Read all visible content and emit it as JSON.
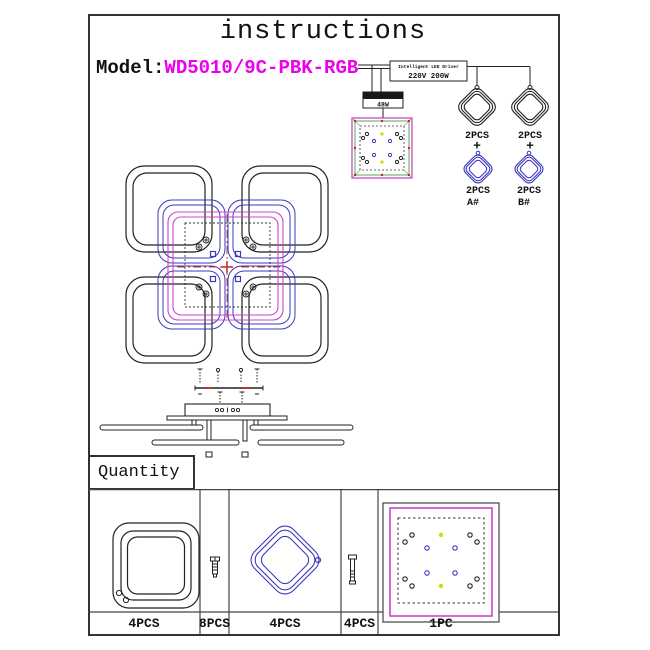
{
  "page": {
    "title": "instructions",
    "model_label": "Model:",
    "model_value": "WD5010/9C-PBK-RGB"
  },
  "wiring": {
    "driver_main": {
      "title": "Intelligent LED Driver",
      "specs": "220V  200W"
    },
    "driver_small": {
      "title": "Intelligent LED Driver",
      "power": "48W"
    },
    "groups": [
      {
        "ring": "black-square-ring",
        "qty_top": "2PCS",
        "plus": "+",
        "qty_bottom": "2PCS",
        "variant": "A#"
      },
      {
        "ring": "black-square-ring",
        "qty_top": "2PCS",
        "plus": "+",
        "qty_bottom": "2PCS",
        "variant": "B#"
      }
    ]
  },
  "quantity": {
    "header": "Quantity",
    "parts": [
      {
        "item": "black-square-ring",
        "qty": "4PCS"
      },
      {
        "item": "short-screw",
        "qty": "8PCS"
      },
      {
        "item": "blue-diamond-ring",
        "qty": "4PCS"
      },
      {
        "item": "long-screw",
        "qty": "4PCS"
      },
      {
        "item": "center-panel",
        "qty": "1PC"
      }
    ]
  },
  "colors": {
    "model_text": "#ee00ee",
    "ring_blue": "#3a3ac0",
    "panel_magenta": "#cc44cc",
    "panel_green": "#55aa55",
    "centerline_red": "#cc3322",
    "dot_yellow": "#d8d800",
    "line": "#222222"
  }
}
